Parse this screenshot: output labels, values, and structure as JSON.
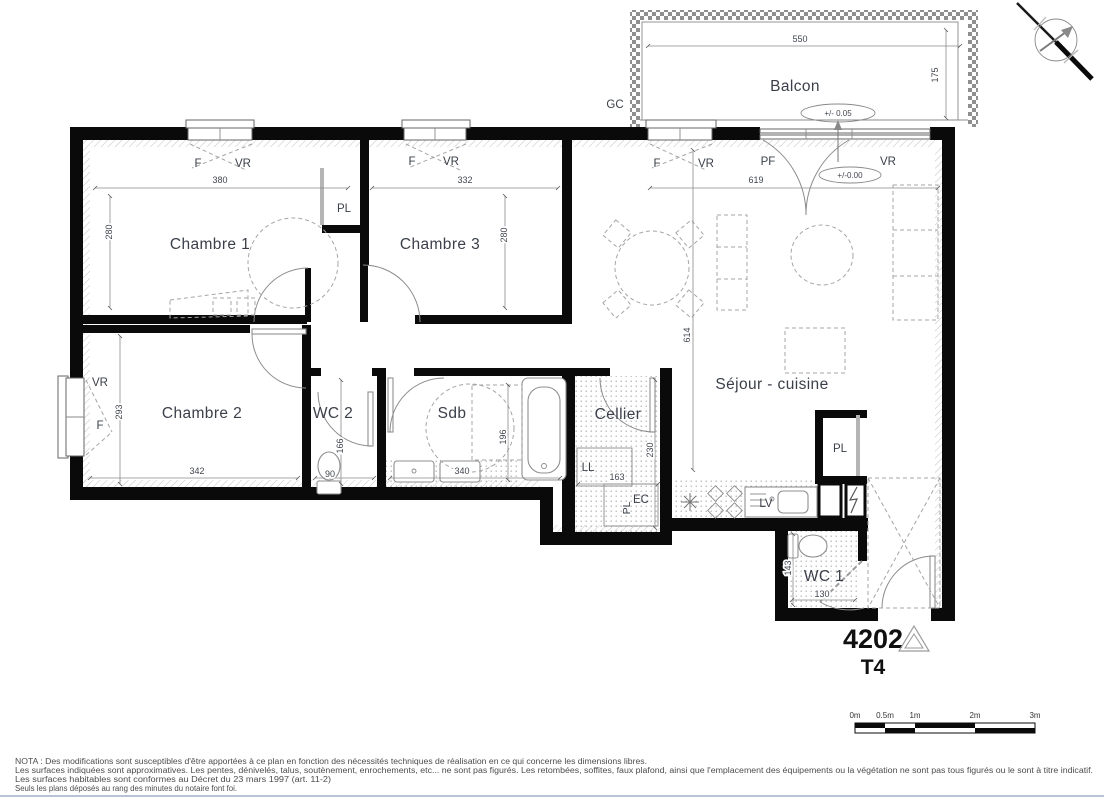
{
  "title": {
    "unit_number": "4202",
    "unit_type": "T4"
  },
  "rooms": {
    "balcon": "Balcon",
    "chambre1": "Chambre 1",
    "chambre3": "Chambre 3",
    "chambre2": "Chambre 2",
    "wc2": "WC 2",
    "sdb": "Sdb",
    "cellier": "Cellier",
    "sejour": "Séjour - cuisine",
    "wc1": "WC 1"
  },
  "openings": {
    "window": "F",
    "shutter": "VR",
    "french_door": "PF",
    "gc": "GC"
  },
  "fixtures": {
    "closet": "PL",
    "washer": "LL",
    "dishwasher": "LV",
    "water_heater": "EC"
  },
  "levels": {
    "balcony": "+/- 0.05",
    "floor": "+/-0.00"
  },
  "dimensions": {
    "balcony_width": "550",
    "balcony_depth": "175",
    "chambre1_width": "380",
    "chambre1_depth": "280",
    "chambre3_width": "332",
    "chambre3_depth": "280",
    "sejour_width": "619",
    "sejour_depth": "614",
    "chambre2_width": "342",
    "chambre2_depth": "293",
    "wc2_width": "90",
    "wc2_depth": "166",
    "sdb_width": "340",
    "sdb_depth": "196",
    "cellier_width": "163",
    "cellier_depth": "230",
    "wc1_width": "130",
    "wc1_depth": "143"
  },
  "scalebar": {
    "m0": "0m",
    "m05": "0.5m",
    "m1": "1m",
    "m2": "2m",
    "m3": "3m"
  },
  "nota": {
    "line1": "NOTA : Des modifications sont susceptibles d'être apportées à ce plan en fonction des nécessités techniques de réalisation en ce qui concerne les dimensions libres.",
    "line2": "Les surfaces indiquées sont approximatives. Les pentes, dénivelés, talus, soutènement, enrochements, etc... ne sont pas figurés. Les retombées, soffites, faux plafond, ainsi que l'emplacement des équipements ou la végétation ne sont pas tous figurés ou le sont à titre indicatif.",
    "line3": "Les surfaces habitables sont conformes au Décret du 23 mars 1997 (art. 11-2)",
    "line4": "Seuls les plans déposés au rang des minutes du notaire font foi."
  },
  "colors": {
    "wall": "#0a0a0a",
    "label": "#3a3f49",
    "dashed_furniture": "#a5a5a5",
    "separator": "#9fb0c7"
  }
}
